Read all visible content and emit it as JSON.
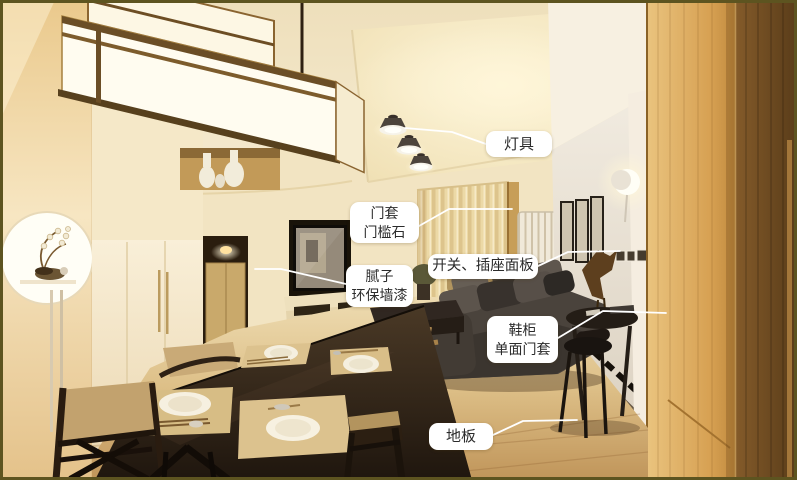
{
  "annotations": [
    {
      "name": "lighting",
      "lines": [
        "灯具"
      ]
    },
    {
      "name": "door-casing-threshold",
      "lines": [
        "门套",
        "门槛石"
      ]
    },
    {
      "name": "switch-socket-panel",
      "lines": [
        "开关、插座面板"
      ]
    },
    {
      "name": "putty-eco-wall-paint",
      "lines": [
        "腻子",
        "环保墙漆"
      ]
    },
    {
      "name": "shoe-cabinet-door-casing",
      "lines": [
        "鞋柜",
        "单面门套"
      ]
    },
    {
      "name": "wood-floor",
      "lines": [
        "地板"
      ]
    }
  ],
  "colors": {
    "frame_border": "#5d5420",
    "label_background": "#ffffff",
    "label_text": "#2b2b2b",
    "leader_line": "#ffffff"
  }
}
